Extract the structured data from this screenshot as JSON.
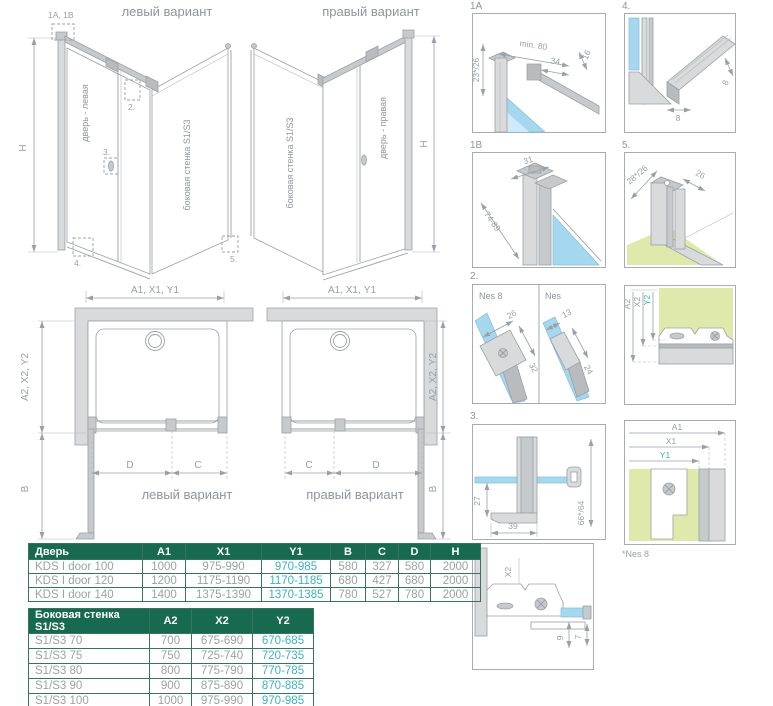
{
  "colors": {
    "accent_teal": "#3fb1c1",
    "table_header_green": "#176950",
    "line_gray": "#9aa0a6",
    "glass_blue": "#a5d7ef",
    "floor_green": "#dfe9ab"
  },
  "iso_left": {
    "title": "левый вариант",
    "door_label": "дверь - левая",
    "wall_label": "боковая стенка S1/S3",
    "h_label": "H",
    "callout_1": "1A, 1B",
    "callout_2": "2.",
    "callout_3": "3.",
    "callout_4": "4.",
    "callout_5": "5."
  },
  "iso_right": {
    "title": "правый вариант",
    "door_label": "дверь - правая",
    "wall_label": "боковая стенка S1/S3",
    "h_label": "H"
  },
  "plan_left": {
    "dim_top_gray": "A1, X1,",
    "dim_top_teal": "Y1",
    "dim_side_gray": "A2, X2,",
    "dim_side_teal": "Y2",
    "dim_b": "B",
    "dim_d": "D",
    "dim_c": "C",
    "caption": "левый вариант"
  },
  "plan_right": {
    "dim_top_gray": "A1, X1,",
    "dim_top_teal": "Y1",
    "dim_side_gray": "A2, X2,",
    "dim_side_teal": "Y2",
    "dim_b": "B",
    "dim_d": "D",
    "dim_c": "C",
    "caption": "правый вариант"
  },
  "details": {
    "d1a": {
      "label": "1A",
      "dim_wall": "23*/26",
      "dim_min": "min. 80",
      "dim_34": "34",
      "dim_16": "16"
    },
    "d1b": {
      "label": "1B",
      "dim_31": "31",
      "dim_range": "74-89"
    },
    "d2": {
      "label": "2.",
      "left_name": "Nes 8",
      "right_name": "Nes",
      "dim_26": "26",
      "dim_32": "32",
      "dim_13": "13",
      "dim_24": "24"
    },
    "d3": {
      "label": "3.",
      "dim_27": "27",
      "dim_39": "39",
      "dim_66": "66*/64"
    },
    "d4": {
      "label": "4.",
      "dim_w": "8",
      "dim_h": "8"
    },
    "d5": {
      "label": "5.",
      "dim_a": "28*/26",
      "dim_b": "26"
    },
    "d6": {
      "dim_a2": "A2",
      "dim_x2": "X2",
      "dim_y2": "Y2"
    },
    "d7": {
      "dim_a1": "A1",
      "dim_x1": "X1",
      "dim_y1": "Y1",
      "note": "*Nes 8"
    },
    "d8": {
      "dim_x2": "X2",
      "dim_9": "9",
      "dim_7": "7"
    }
  },
  "door_table": {
    "headers": [
      "Дверь",
      "A1",
      "X1",
      "Y1",
      "B",
      "C",
      "D",
      "H"
    ],
    "accent_col": 3,
    "rows": [
      [
        "KDS I door 100",
        "1000",
        "975-990",
        "970-985",
        "580",
        "327",
        "580",
        "2000"
      ],
      [
        "KDS I door 120",
        "1200",
        "1175-1190",
        "1170-1185",
        "680",
        "427",
        "680",
        "2000"
      ],
      [
        "KDS I door 140",
        "1400",
        "1375-1390",
        "1370-1385",
        "780",
        "527",
        "780",
        "2000"
      ]
    ]
  },
  "side_table": {
    "headers": [
      "Боковая стенка S1/S3",
      "A2",
      "X2",
      "Y2"
    ],
    "accent_col": 3,
    "rows": [
      [
        "S1/S3 70",
        "700",
        "675-690",
        "670-685"
      ],
      [
        "S1/S3 75",
        "750",
        "725-740",
        "720-735"
      ],
      [
        "S1/S3 80",
        "800",
        "775-790",
        "770-785"
      ],
      [
        "S1/S3 90",
        "900",
        "875-890",
        "870-885"
      ],
      [
        "S1/S3 100",
        "1000",
        "975-990",
        "970-985"
      ]
    ]
  }
}
